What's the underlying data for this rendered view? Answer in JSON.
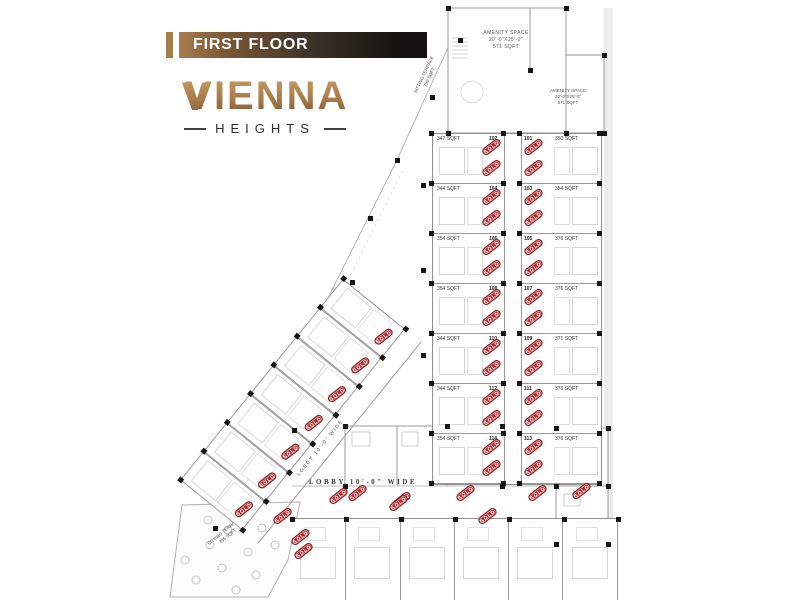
{
  "header": {
    "title": "FIRST FLOOR"
  },
  "logo": {
    "monogram": "V",
    "name": "VIENNA",
    "subtitle": "HEIGHTS"
  },
  "stamp": {
    "label": "SOLD"
  },
  "colors": {
    "banner_gold": "#a57c4b",
    "banner_dark": "#15130f",
    "logo_gold": "#a77b4a",
    "sold_red": "#b5292c",
    "plan_line": "#9a9a9a",
    "column_black": "#161616"
  },
  "plan": {
    "corridor_label_vertical": "LOBBY 10'-0\" WIDE",
    "corridor_label_vertical_2": "LOBBY 10'-0\" WIDE",
    "corridor_label_diagonal": "LOBBY 10'-0\" WIDE",
    "corridor_label_bottom": "LOBBY 10'-0\" WIDE",
    "amenity_top": {
      "line1": "AMENITY SPACE",
      "line2": "20'-0\"X25'-0\"",
      "line3": "571 SQFT"
    },
    "amenity_right": {
      "line1": "AMENITY SPACE",
      "line2": "20'-0\"X25'-0\"",
      "line3": "571 SQFT"
    },
    "terrace_top": {
      "line1": "SITTING TERRACE",
      "line2": "750 SQFT"
    },
    "terrace_bottom": {
      "line1": "SITTING TERRACE",
      "line2": "765 SQFT"
    },
    "central_rows": [
      {
        "left_sqft": "347 SQFT",
        "left_no": "102",
        "right_no": "101",
        "right_sqft": "350 SQFT",
        "sold": true
      },
      {
        "left_sqft": "344 SQFT",
        "left_no": "104",
        "right_no": "103",
        "right_sqft": "354 SQFT",
        "sold": true
      },
      {
        "left_sqft": "354 SQFT",
        "left_no": "106",
        "right_no": "105",
        "right_sqft": "376 SQFT",
        "sold": true
      },
      {
        "left_sqft": "354 SQFT",
        "left_no": "108",
        "right_no": "107",
        "right_sqft": "376 SQFT",
        "sold": true
      },
      {
        "left_sqft": "344 SQFT",
        "left_no": "110",
        "right_no": "109",
        "right_sqft": "371 SQFT",
        "sold": true
      },
      {
        "left_sqft": "344 SQFT",
        "left_no": "112",
        "right_no": "111",
        "right_sqft": "376 SQFT",
        "sold": true
      },
      {
        "left_sqft": "354 SQFT",
        "left_no": "114",
        "right_no": "113",
        "right_sqft": "376 SQFT",
        "sold": true
      }
    ],
    "wing_units": [
      {
        "sold": true
      },
      {
        "sold": true
      },
      {
        "sold": true
      },
      {
        "sold": true
      },
      {
        "sold": true
      },
      {
        "sold": true
      },
      {
        "sold": true
      }
    ],
    "bottom_units": [
      {
        "sold": true
      },
      {
        "sold": true
      },
      {
        "sold": true
      },
      {
        "sold": true
      },
      {
        "sold": true
      },
      {
        "sold": true
      }
    ],
    "mid_units": [
      {
        "sold": true
      },
      {
        "sold": true
      },
      {
        "sold": true
      },
      {
        "sold": true
      },
      {
        "sold": true
      }
    ]
  }
}
